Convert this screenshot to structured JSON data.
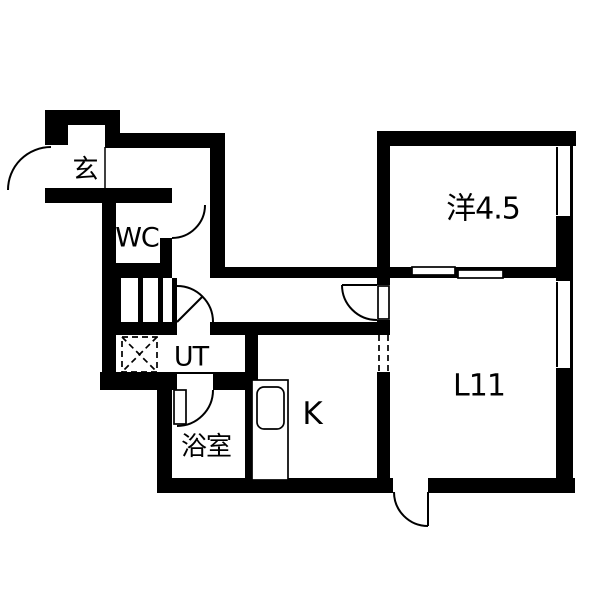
{
  "floorplan": {
    "background_color": "#ffffff",
    "wall_color": "#000000",
    "line_color": "#000000",
    "rooms": [
      {
        "id": "genkan",
        "label": "玄"
      },
      {
        "id": "wc",
        "label": "WC"
      },
      {
        "id": "utility",
        "label": "UT"
      },
      {
        "id": "bathroom",
        "label": "浴室"
      },
      {
        "id": "kitchen",
        "label": "K"
      },
      {
        "id": "living-dining",
        "label": "L11"
      },
      {
        "id": "western-room",
        "label": "洋4.5"
      }
    ],
    "walls": [
      {
        "name": "entrance-top-wall",
        "r": [
          45,
          110,
          75,
          15
        ]
      },
      {
        "name": "entrance-left-wall",
        "r": [
          45,
          125,
          23,
          20
        ]
      },
      {
        "name": "entrance-niche-post",
        "r": [
          105,
          110,
          15,
          38
        ]
      },
      {
        "name": "hall-top-wall",
        "r": [
          120,
          133,
          105,
          15
        ]
      },
      {
        "name": "hall-east-wall",
        "r": [
          210,
          148,
          15,
          130
        ]
      },
      {
        "name": "corridor-north-wall",
        "r": [
          210,
          267,
          180,
          11
        ]
      },
      {
        "name": "western-room-south-wall",
        "r": [
          390,
          267,
          166,
          11
        ]
      },
      {
        "name": "entrance-south-wall",
        "r": [
          45,
          188,
          127,
          15
        ]
      },
      {
        "name": "west-outer-wall",
        "r": [
          102,
          203,
          14,
          187
        ]
      },
      {
        "name": "wc-east-wall",
        "r": [
          160,
          238,
          12,
          25
        ]
      },
      {
        "name": "wc-south-wall",
        "r": [
          102,
          263,
          70,
          17
        ]
      },
      {
        "name": "storage-block",
        "r": [
          116,
          278,
          61,
          44
        ]
      },
      {
        "name": "corridor-south-wall",
        "r": [
          102,
          322,
          288,
          13
        ]
      },
      {
        "name": "utility-south-wall",
        "r": [
          100,
          372,
          145,
          18
        ]
      },
      {
        "name": "bathroom-west-wall",
        "r": [
          157,
          388,
          15,
          97
        ]
      },
      {
        "name": "south-outer-wall",
        "r": [
          157,
          478,
          418,
          15
        ]
      },
      {
        "name": "kitchen-west-wall",
        "r": [
          245,
          335,
          13,
          145
        ]
      },
      {
        "name": "center-vertical-wall",
        "r": [
          377,
          131,
          13,
          349
        ]
      },
      {
        "name": "north-outer-wall",
        "r": [
          377,
          131,
          199,
          15
        ]
      },
      {
        "name": "east-outer-wall",
        "r": [
          556,
          131,
          17,
          362
        ]
      }
    ],
    "openings": [
      {
        "name": "entrance-niche",
        "r": [
          68,
          125,
          37,
          20
        ]
      },
      {
        "name": "entrance-door-opening",
        "r": [
          45,
          145,
          12,
          43
        ]
      },
      {
        "name": "wc-door-opening",
        "r": [
          160,
          203,
          12,
          35
        ]
      },
      {
        "name": "storage-slot-1",
        "r": [
          121,
          278,
          17,
          44
        ]
      },
      {
        "name": "storage-slot-2",
        "r": [
          143,
          278,
          15,
          44
        ]
      },
      {
        "name": "storage-slot-3",
        "r": [
          163,
          278,
          9,
          44
        ]
      },
      {
        "name": "utility-door-opening",
        "r": [
          177,
          322,
          33,
          13
        ]
      },
      {
        "name": "bathroom-door-opening",
        "r": [
          177,
          374,
          36,
          16
        ]
      },
      {
        "name": "living-door-opening",
        "r": [
          377,
          285,
          13,
          35
        ]
      },
      {
        "name": "kitchen-living-opening",
        "r": [
          377,
          335,
          13,
          37
        ]
      },
      {
        "name": "western-room-window",
        "r": [
          556,
          146,
          14,
          70
        ]
      },
      {
        "name": "living-window",
        "r": [
          556,
          281,
          14,
          87
        ]
      },
      {
        "name": "balcony-door-opening",
        "r": [
          393,
          478,
          35,
          15
        ]
      }
    ],
    "panels": [
      {
        "name": "sliding-door-panel-1",
        "r": [
          412,
          267,
          43,
          8
        ],
        "rx": 0
      },
      {
        "name": "sliding-door-panel-2",
        "r": [
          458,
          270,
          45,
          8
        ],
        "rx": 0
      },
      {
        "name": "bathroom-door-leaf",
        "r": [
          174,
          390,
          12,
          34
        ],
        "rx": 0
      },
      {
        "name": "living-door-leaf",
        "r": [
          378,
          286,
          11,
          33
        ],
        "rx": 0
      },
      {
        "name": "kitchen-counter",
        "r": [
          252,
          380,
          36,
          100
        ],
        "rx": 0
      },
      {
        "name": "kitchen-sink",
        "r": [
          257,
          387,
          27,
          42
        ],
        "rx": 7
      }
    ],
    "arcs": [
      {
        "name": "entrance-door-arc",
        "d": "M 51,147 A 43,43 0 0 0 8,190"
      },
      {
        "name": "wc-door-arc",
        "d": "M 205,205 A 33,33 0 0 1 172,238"
      },
      {
        "name": "utility-door-arc",
        "d": "M 177,286 A 36,36 0 0 1 213,322"
      },
      {
        "name": "bathroom-door-arc",
        "d": "M 213,390 A 36,36 0 0 1 177,426"
      },
      {
        "name": "living-door-arc",
        "d": "M 342,285 A 35,35 0 0 0 377,320"
      },
      {
        "name": "balcony-door-arc",
        "d": "M 394,492 A 34,34 0 0 0 428,526"
      }
    ],
    "lines": [
      {
        "name": "utility-door-leaf-line",
        "d": "M 177,322 L 203,296",
        "w": 2
      },
      {
        "name": "living-door-leaf-line",
        "d": "M 342,285 L 377,285",
        "w": 2
      },
      {
        "name": "balcony-door-leaf-line",
        "d": "M 428,492 L 428,526",
        "w": 2
      },
      {
        "name": "entrance-step-line",
        "d": "M 105,147 L 105,188",
        "w": 1.5
      },
      {
        "name": "western-room-window-line",
        "d": "M 557,147 L 557,215",
        "w": 2
      },
      {
        "name": "living-window-line",
        "d": "M 557,282 L 557,367",
        "w": 2
      }
    ],
    "dashed": [
      {
        "name": "washer-pan-outline",
        "d": "M 122,337 h 35 v 35 h -35 Z"
      },
      {
        "name": "washer-pan-cross-1",
        "d": "M 122,337 L 157,372"
      },
      {
        "name": "washer-pan-cross-2",
        "d": "M 157,337 L 122,372"
      },
      {
        "name": "kitchen-living-opening-edge-1",
        "d": "M 379,335 L 379,372"
      },
      {
        "name": "kitchen-living-opening-edge-2",
        "d": "M 388,335 L 388,372"
      }
    ]
  }
}
